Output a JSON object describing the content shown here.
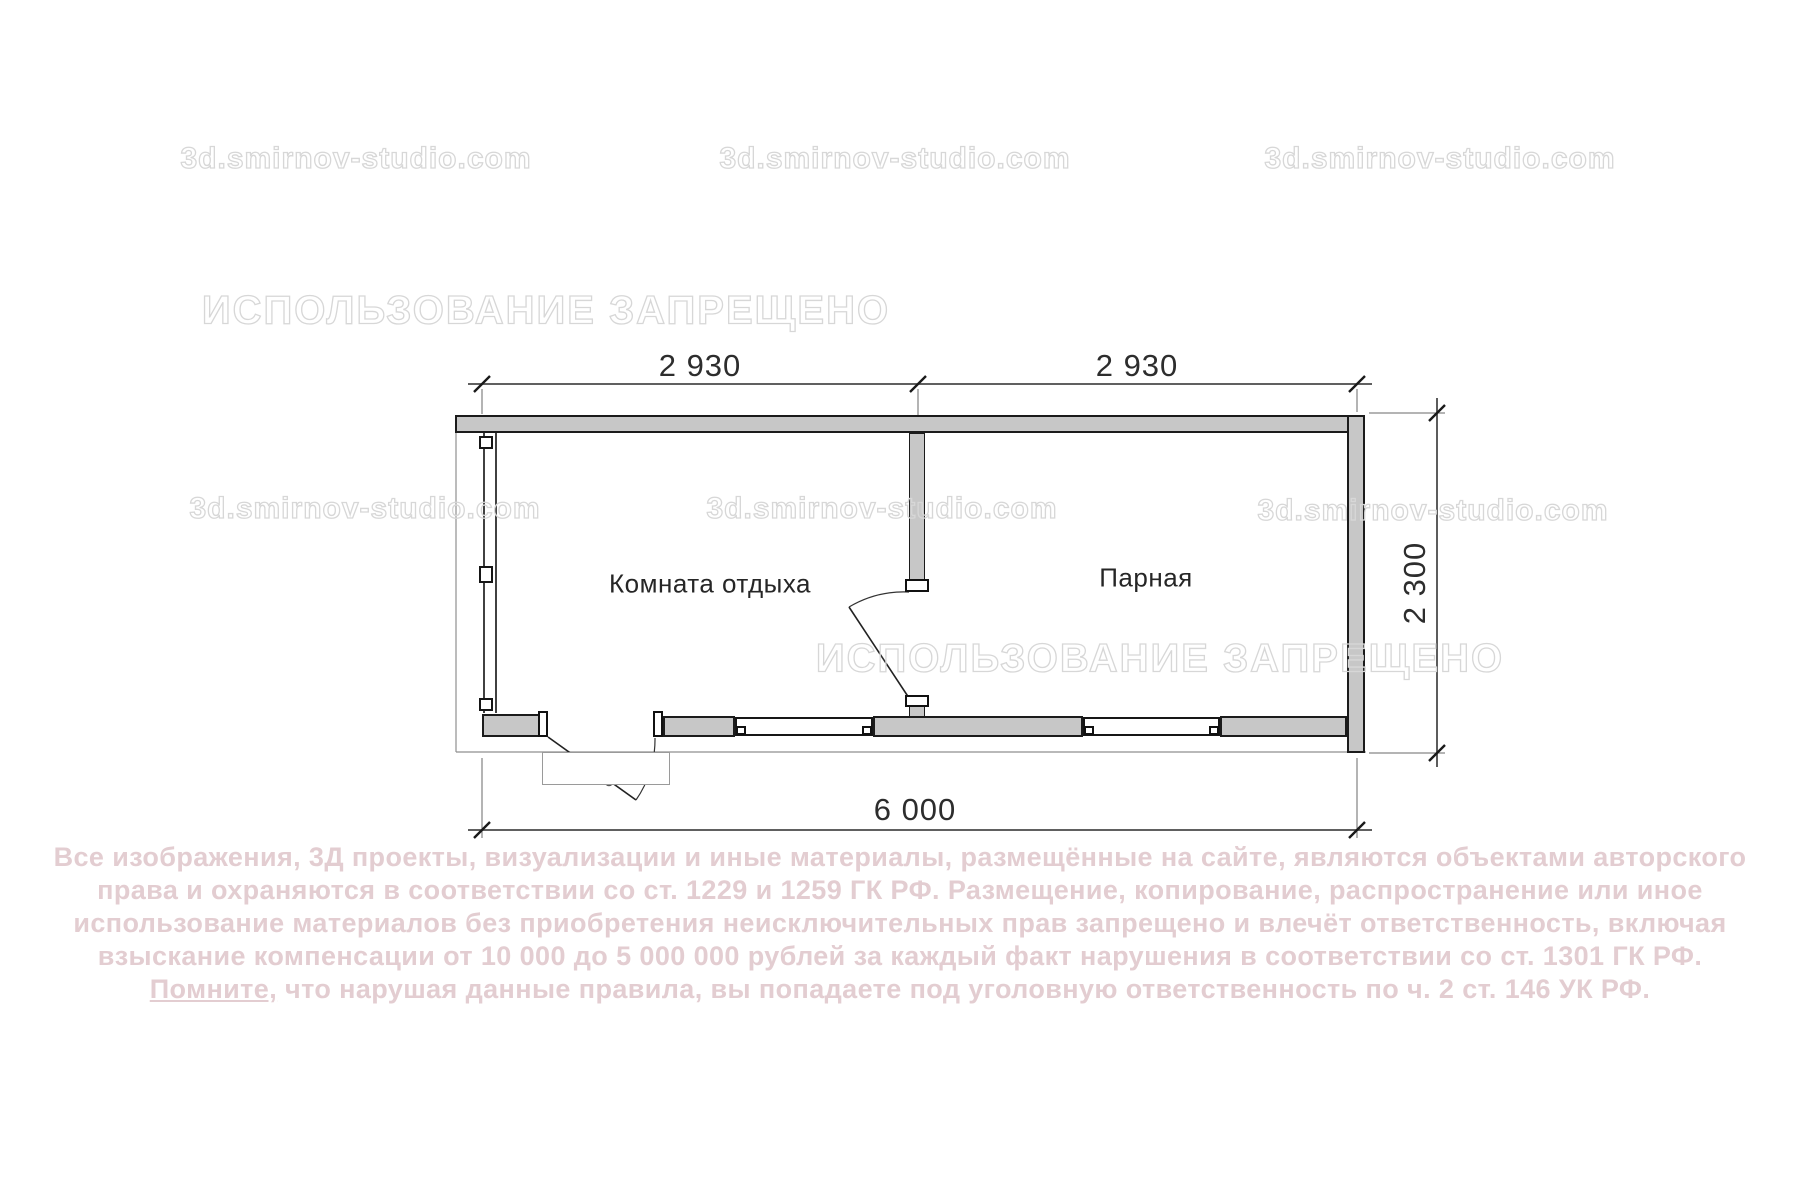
{
  "plan": {
    "room1_label": "Комната отдыха",
    "room2_label": "Парная",
    "dim_top_left": "2 930",
    "dim_top_right": "2 930",
    "dim_bottom": "6 000",
    "dim_right": "2 300"
  },
  "watermarks": {
    "site": "3d.smirnov-studio.com",
    "forbidden": "ИСПОЛЬЗОВАНИЕ ЗАПРЕЩЕНО"
  },
  "copyright": {
    "line1": "Все изображения, 3Д проекты, визуализации и иные материалы, размещённые на сайте, являются объектами авторского",
    "line2": "права и охраняются в соответствии со ст. 1229 и 1259 ГК РФ. Размещение, копирование, распространение или иное",
    "line3": "использование материалов без приобретения неисключительных прав запрещено и влечёт ответственность, включая",
    "line4": "взыскание компенсации от 10 000 до 5 000 000 рублей за каждый факт нарушения в соответствии со ст. 1301 ГК РФ.",
    "line5_underlined": "Помните,",
    "line5_rest": " что нарушая данные правила, вы попадаете под уголовную ответственность по ч. 2 ст. 146 УК РФ."
  },
  "colors": {
    "wall_fill": "#c7c7c7",
    "wall_outline": "#1b1b1b",
    "watermark": "#d7d7d7",
    "copyright_text": "#e3cdd1"
  }
}
